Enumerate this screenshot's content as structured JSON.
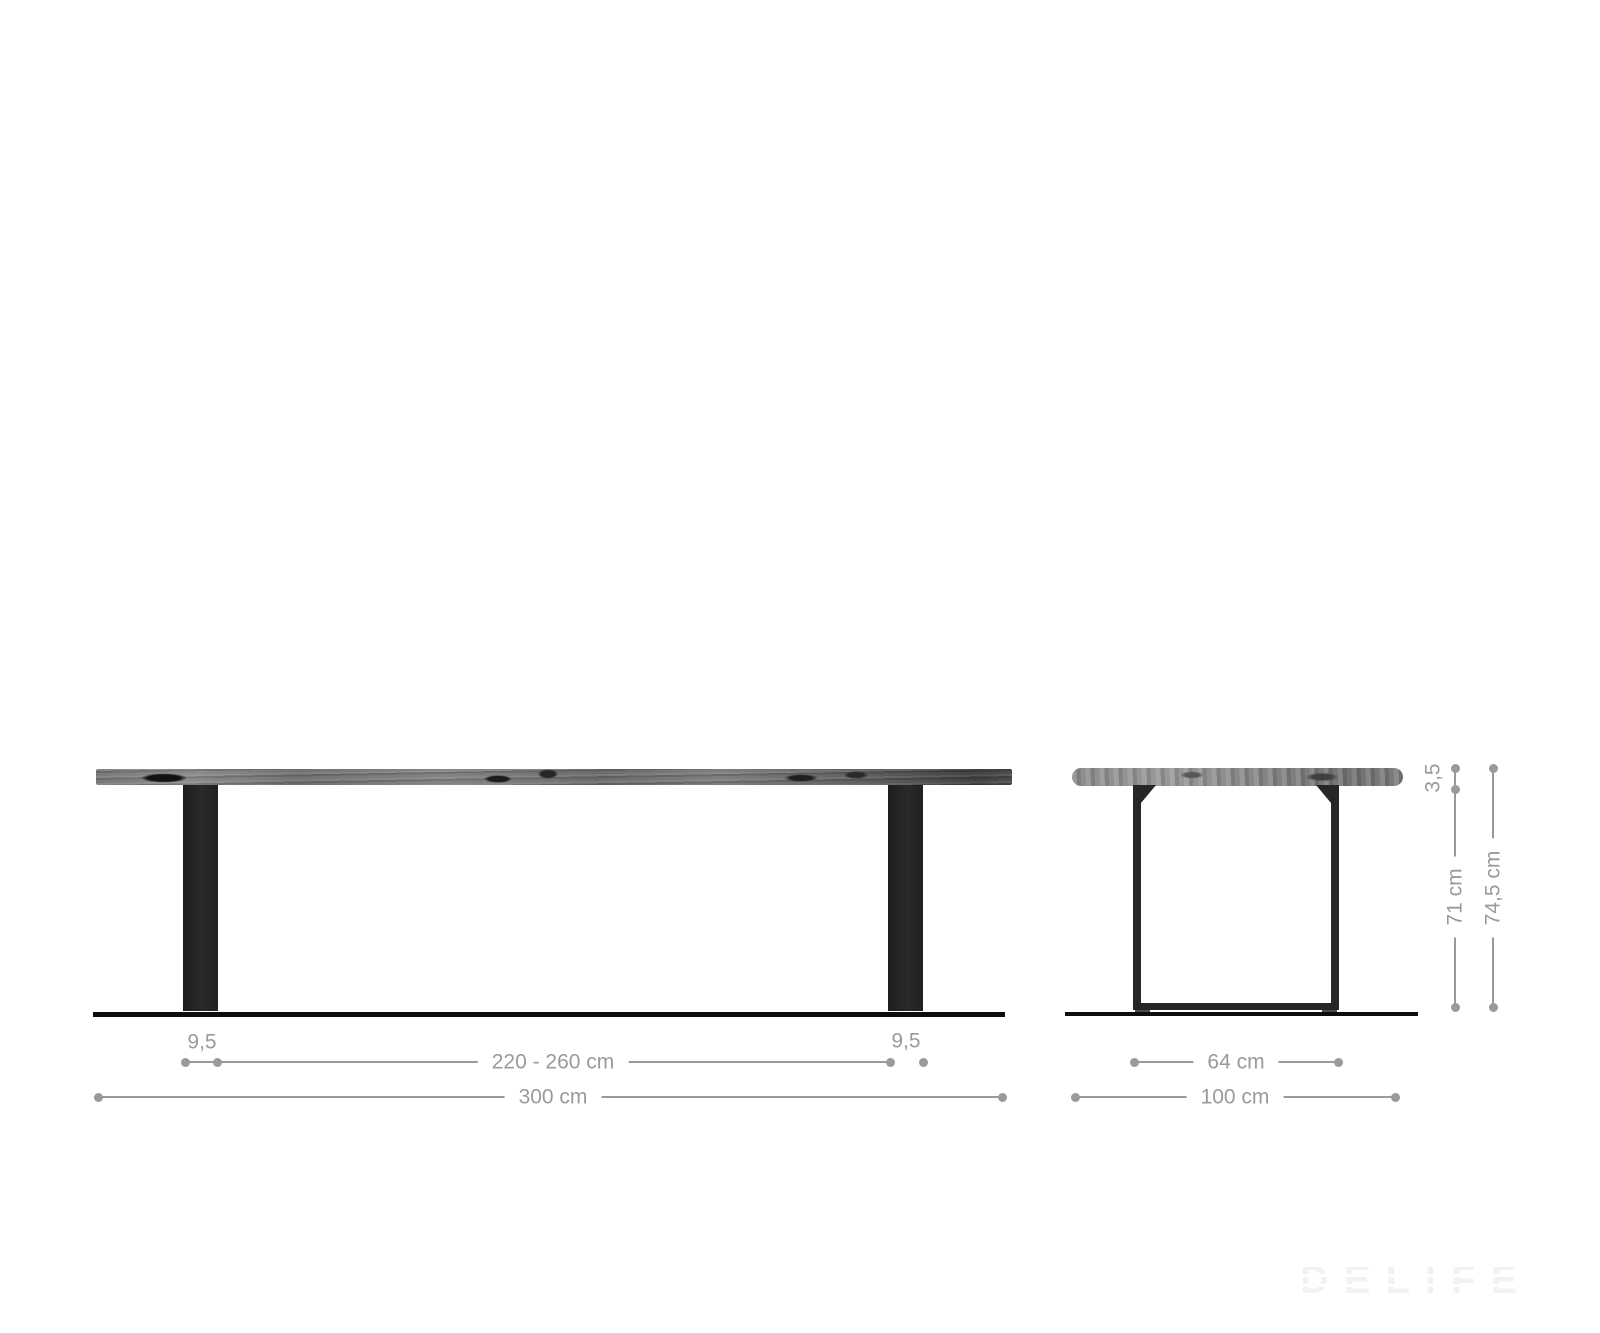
{
  "diagram": {
    "type": "furniture-dimension-drawing",
    "views": [
      "front-elevation",
      "side-elevation"
    ]
  },
  "front_view": {
    "labels": {
      "leg_width_left": "9,5",
      "leg_span": "220 - 260 cm",
      "leg_width_right": "9,5",
      "total_width": "300 cm"
    }
  },
  "side_view": {
    "labels": {
      "tabletop_thickness": "3,5",
      "frame_height": "71 cm",
      "total_height": "74,5 cm",
      "frame_depth": "64 cm",
      "total_depth": "100 cm"
    }
  },
  "watermark": {
    "text": "DELIFE"
  },
  "colors": {
    "dimension_gray": "#9a9a9a",
    "frame_black": "#262626",
    "floor_black": "#0d0d0d",
    "watermark_gray": "#f2f2f2",
    "background": "#ffffff"
  }
}
